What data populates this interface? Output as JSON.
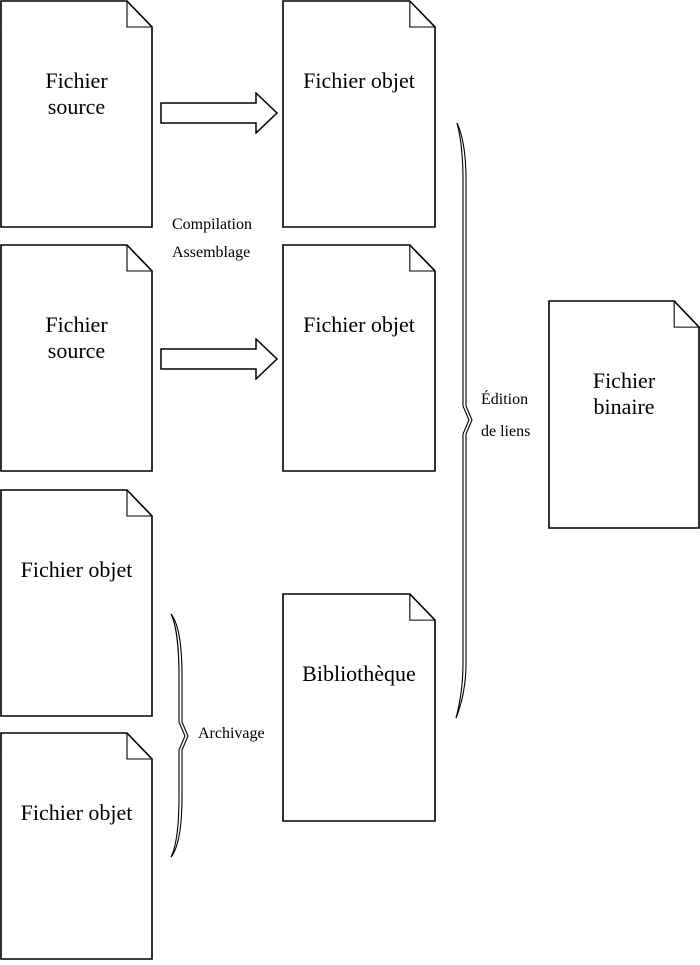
{
  "diagram_title": "Processus de compilation et d'édition de liens",
  "documents": [
    {
      "name": "fichier-source-1",
      "line1": "Fichier",
      "line2": "source"
    },
    {
      "name": "fichier-source-2",
      "line1": "Fichier",
      "line2": "source"
    },
    {
      "name": "fichier-objet-left-1",
      "line1": "Fichier objet",
      "line2": ""
    },
    {
      "name": "fichier-objet-left-2",
      "line1": "Fichier objet",
      "line2": ""
    },
    {
      "name": "fichier-objet-mid-1",
      "line1": "Fichier objet",
      "line2": ""
    },
    {
      "name": "fichier-objet-mid-2",
      "line1": "Fichier objet",
      "line2": ""
    },
    {
      "name": "bibliotheque",
      "line1": "Bibliothèque",
      "line2": ""
    },
    {
      "name": "fichier-binaire",
      "line1": "Fichier",
      "line2": "binaire"
    }
  ],
  "labels": {
    "compilation_line1": "Compilation",
    "compilation_line2": "Assemblage",
    "edition_line1": "Édition",
    "edition_line2": "de liens",
    "archivage": "Archivage"
  },
  "colors": {
    "line": "#000000",
    "text": "#000000",
    "background": "#ffffff"
  }
}
